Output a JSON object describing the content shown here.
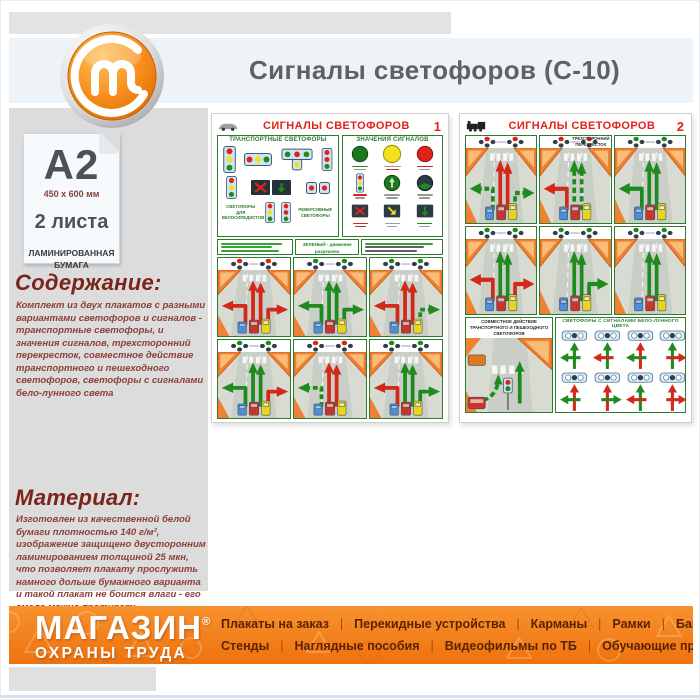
{
  "header": {
    "title": "Сигналы светофоров (С-10)"
  },
  "product_card": {
    "format": "A2",
    "dimensions": "450 x 600 мм",
    "sheets": "2 листа",
    "paper": "ЛАМИНИРОВАННАЯ\nБУМАГА"
  },
  "sections": {
    "contents_heading": "Содержание:",
    "contents_text": "Комплект из двух плакатов с разными вариантами светофоров и сигналов - транспортные светофоры, и значения сигналов, трехсторонний перекресток, совместное действие транспортного и пешеходного светофоров, светофоры с сигналами бело-лунного света",
    "material_heading": "Материал:",
    "material_text": "Изготовлен из качественной белой бумаги плотностью 140 г/м², изображение защищено двусторонним ламинированием толщиной 25 мкн, что позволяет плакату прослужить намного дольше бумажного варианта и такой плакат не боится влаги - его смело можно протирать."
  },
  "posters": [
    {
      "title": "СИГНАЛЫ СВЕТОФОРОВ",
      "number": "1",
      "labels": {
        "transport": "ТРАНСПОРТНЫЕ СВЕТОФОРЫ",
        "meanings": "ЗНАЧЕНИЯ СИГНАЛОВ",
        "bicycles": "СВЕТОФОРЫ ДЛЯ ВЕЛОСИПЕДИСТОВ",
        "reversive": "РЕВЕРСИВНЫЕ СВЕТОФОРЫ",
        "green_rule": "ЗЕЛЕНЫЙ - движение разрешено",
        "red_rule": "КРАСНЫЙ - движение запрещено"
      },
      "road_cells": [
        {
          "left": "red",
          "straight": "red",
          "right": "red",
          "light": "red"
        },
        {
          "left": "green",
          "straight": "green",
          "right": "green",
          "light": "green"
        },
        {
          "left": "red",
          "straight": "red",
          "right": "green-dash",
          "light": "green"
        },
        {
          "left": "green",
          "straight": "green",
          "right": "red",
          "light": "green"
        },
        {
          "left": "green-dash",
          "straight": "red",
          "right": "none",
          "light": "red"
        },
        {
          "left": "red",
          "straight": "green",
          "right": "green",
          "light": "green"
        }
      ]
    },
    {
      "title": "СИГНАЛЫ СВЕТОФОРОВ",
      "number": "2",
      "labels": {
        "three_way": "ТРЕХСТОРОННИЙ ПЕРЕКРЕСТОК",
        "joint": "СОВМЕСТНОЕ ДЕЙСТВИЕ ТРАНСПОРТНОГО И ПЕШЕХОДНОГО СВЕТОФОРОВ",
        "moon": "СВЕТОФОРЫ С СИГНАЛАМИ БЕЛО-ЛУННОГО ЦВЕТА"
      },
      "road_cells_top": [
        {
          "left": "green-dash",
          "straight": "red",
          "right": "green-dash",
          "light": "red"
        },
        {
          "left": "red",
          "straight": "green-dash",
          "right": "none",
          "light": "red"
        },
        {
          "left": "green",
          "straight": "green",
          "right": "none",
          "light": "green"
        }
      ],
      "road_cells_mid": [
        {
          "left": "red",
          "straight": "green",
          "right": "red",
          "light": "green"
        },
        {
          "left": "none",
          "straight": "green",
          "right": "green",
          "light": "green"
        },
        {
          "left": "none",
          "straight": "green",
          "right": "none",
          "light": "green"
        }
      ],
      "moon_items": [
        {
          "up": "green",
          "side": "green",
          "dir": "left"
        },
        {
          "up": "green",
          "side": "red",
          "dir": "left"
        },
        {
          "up": "red",
          "side": "green",
          "dir": "left"
        },
        {
          "up": "green",
          "side": "red",
          "dir": "right"
        },
        {
          "up": "red",
          "side": "green",
          "dir": "left"
        },
        {
          "up": "red",
          "side": "green",
          "dir": "right"
        },
        {
          "up": "green",
          "side": "red",
          "dir": "left"
        },
        {
          "up": "red",
          "side": "red",
          "dir": "right"
        }
      ]
    }
  ],
  "footer": {
    "brand_line1": "МАГАЗИН",
    "brand_reg": "®",
    "brand_line2": "ОХРАНЫ ТРУДА",
    "menu_row1": [
      "Плакаты на заказ",
      "Перекидные устройства",
      "Карманы",
      "Рамки",
      "Багет"
    ],
    "menu_row2": [
      "Стенды",
      "Наглядные пособия",
      "Видеофильмы по ТБ",
      "Обучающие программы"
    ]
  },
  "colors": {
    "accent_orange": "#f5821f",
    "title_grey": "#5e6265",
    "heading_dark_red": "#7b241c",
    "poster_red": "#e0231c",
    "poster_green": "#2e7d2e"
  }
}
